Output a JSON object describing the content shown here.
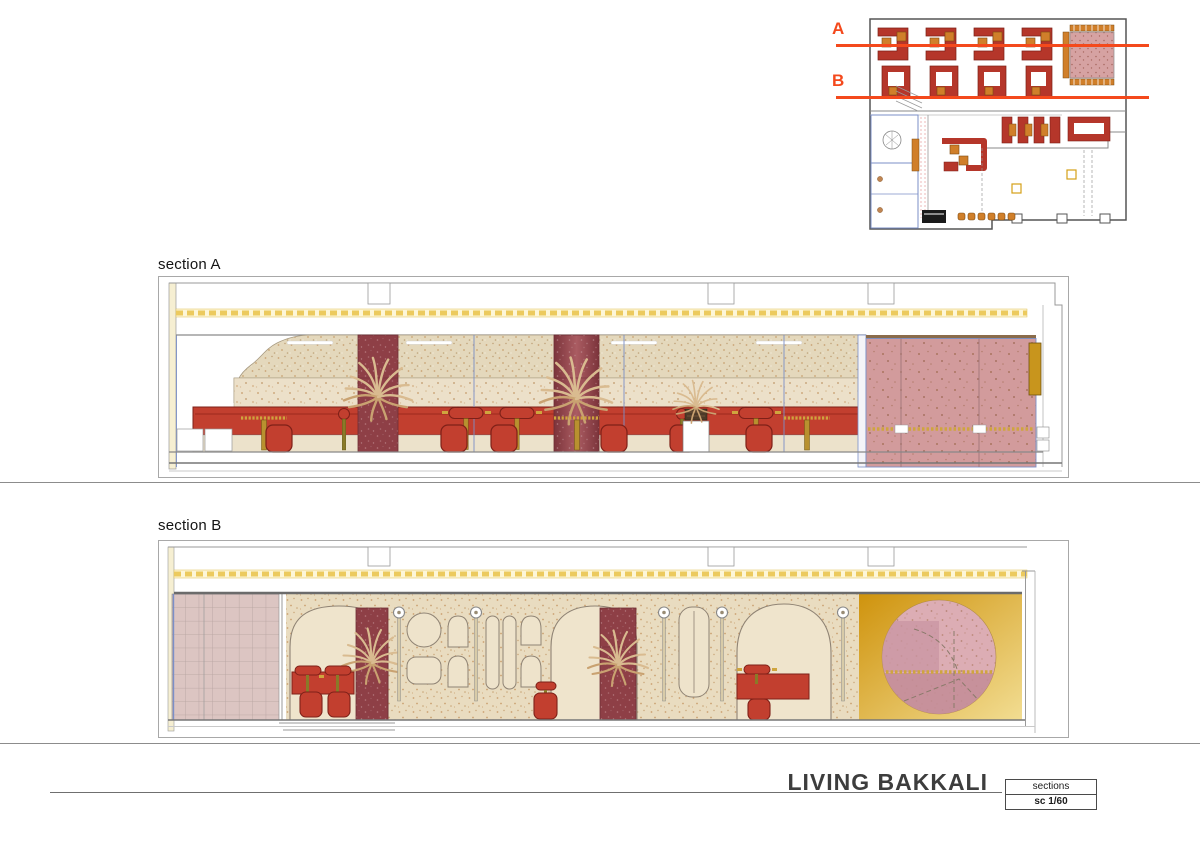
{
  "document": {
    "sections": {
      "a": "section A",
      "b": "section B"
    },
    "plan_markers": {
      "a": "A",
      "b": "B"
    },
    "footer": {
      "title": "LIVING BAKKALI",
      "sheet_name": "sections",
      "scale": "sc 1/60"
    }
  },
  "colors": {
    "marker": "#f4491c",
    "ink": "#3d3d3d",
    "seat-red": "#c23f2f",
    "seat-red-outline": "#7e2018",
    "maroon": "#8e3f46",
    "beige": "#ebdfc7",
    "pink-panel": "#d29b9c",
    "tile-pink": "#dcc5c2",
    "gold": "#c8951d",
    "hatch-yellow": "#ecca5e",
    "brass": "#b8912f",
    "plan-blue": "#7b8fc7"
  }
}
